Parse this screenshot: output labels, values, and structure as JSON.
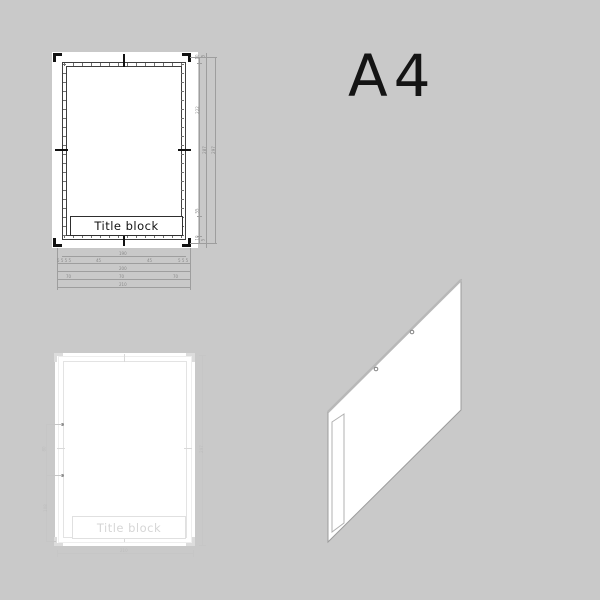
{
  "background": "#c9c9c9",
  "format_label": "A4",
  "dimensioned_sheet": {
    "title_block_label": "Title block",
    "right_dims": {
      "inner": [
        "10",
        "222",
        "55",
        "10"
      ],
      "middle": [
        "5",
        "287",
        "5"
      ],
      "outer": [
        "297"
      ]
    },
    "bottom_dims": {
      "row1": [
        "190"
      ],
      "row2": [
        "5 5 5 5",
        "45",
        "45",
        "5 5 5"
      ],
      "row3": [
        "200"
      ],
      "row4": [
        "70",
        "70",
        "70"
      ],
      "row5": [
        "210"
      ]
    }
  },
  "plain_sheet": {
    "title_block_label": "Title block",
    "left_dims": [
      "80",
      "108"
    ],
    "right_dim": "297",
    "bottom_dim": "210"
  },
  "colors": {
    "background": "#c9c9c9",
    "dark_line": "#111111",
    "frame_line": "#3f3f3f",
    "ghost_line": "#e0e0e0",
    "dimension_line": "#9e9e9e",
    "paper": "#ffffff"
  }
}
